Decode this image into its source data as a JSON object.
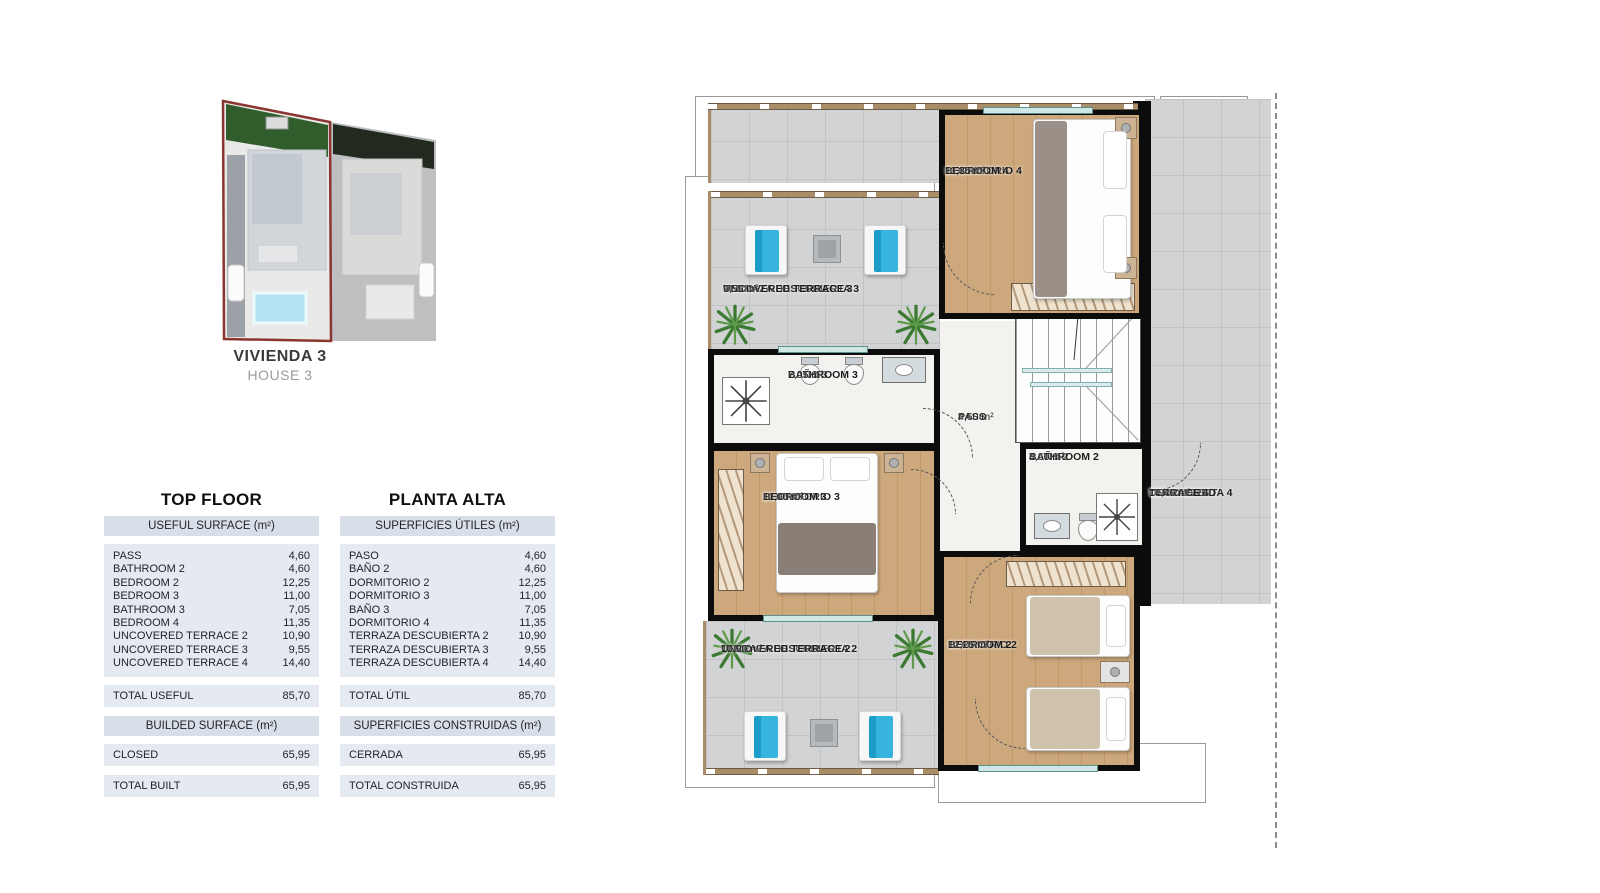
{
  "site_plan": {
    "name_es": "VIVIENDA 3",
    "name_en": "HOUSE 3",
    "highlight_color": "#8a3530"
  },
  "surface_tables": {
    "english": {
      "title": "TOP FLOOR",
      "useful_header": "USEFUL SURFACE (m²)",
      "rows": [
        {
          "label": "PASS",
          "value": "4,60"
        },
        {
          "label": "BATHROOM 2",
          "value": "4,60"
        },
        {
          "label": "BEDROOM 2",
          "value": "12,25"
        },
        {
          "label": "BEDROOM 3",
          "value": "11,00"
        },
        {
          "label": "BATHROOM 3",
          "value": "7,05"
        },
        {
          "label": "BEDROOM 4",
          "value": "11,35"
        },
        {
          "label": "UNCOVERED TERRACE 2",
          "value": "10,90"
        },
        {
          "label": "UNCOVERED TERRACE 3",
          "value": "9,55"
        },
        {
          "label": "UNCOVERED TERRACE 4",
          "value": "14,40"
        }
      ],
      "total": {
        "label": "TOTAL USEFUL",
        "value": "85,70"
      },
      "built_header": "BUILDED SURFACE (m²)",
      "closed": {
        "label": "CLOSED",
        "value": "65,95"
      },
      "total_built": {
        "label": "TOTAL BUILT",
        "value": "65,95"
      }
    },
    "spanish": {
      "title": "PLANTA ALTA",
      "useful_header": "SUPERFICIES ÚTILES (m²)",
      "rows": [
        {
          "label": "PASO",
          "value": "4,60"
        },
        {
          "label": "BAÑO 2",
          "value": "4,60"
        },
        {
          "label": "DORMITORIO 2",
          "value": "12,25"
        },
        {
          "label": "DORMITORIO 3",
          "value": "11,00"
        },
        {
          "label": "BAÑO 3",
          "value": "7,05"
        },
        {
          "label": "DORMITORIO 4",
          "value": "11,35"
        },
        {
          "label": "TERRAZA DESCUBIERTA 2",
          "value": "10,90"
        },
        {
          "label": "TERRAZA DESCUBIERTA 3",
          "value": "9,55"
        },
        {
          "label": "TERRAZA DESCUBIERTA 4",
          "value": "14,40"
        }
      ],
      "total": {
        "label": "TOTAL ÚTIL",
        "value": "85,70"
      },
      "built_header": "SUPERFICIES CONSTRUIDAS (m²)",
      "closed": {
        "label": "CERRADA",
        "value": "65,95"
      },
      "total_built": {
        "label": "TOTAL CONSTRUIDA",
        "value": "65,95"
      }
    }
  },
  "floor_plan": {
    "bedroom4": {
      "es": "DORMITORIO 4",
      "en": "BEDROOM 4",
      "area": "11,35 m²"
    },
    "terrace3": {
      "es": "TERRAZA DESCUBIERTA 3",
      "en": "UNCOVERED TERRACE 3",
      "area": "9,55 m²"
    },
    "bathroom3": {
      "es": "BAÑO 3",
      "en": "BATHROOM 3",
      "area": "7,05 m²"
    },
    "pass": {
      "es": "PASO",
      "en": "PASS",
      "area": "4,60 m²"
    },
    "bathroom2": {
      "es": "BAÑO 2",
      "en": "BATHROOM 2",
      "area": "4,60 m²"
    },
    "bedroom3": {
      "es": "DORMITORIO 3",
      "en": "BEDROOM 3",
      "area": "11,00 m²"
    },
    "terrace4": {
      "es1": "TERRAZA",
      "es2": "DESCUBIERTA 4",
      "en1": "UNCOVERED",
      "en2": "TERRACE 4",
      "area": "14,40 m²"
    },
    "terrace2": {
      "es": "TERRAZA DESCUBIERTA 2",
      "en": "UNCOVERED TERRACE 2",
      "area": "10,90 m²"
    },
    "bedroom2": {
      "es": "DORMITRIO 2",
      "en": "BEDROOM 2",
      "area": "12,25 m²"
    }
  },
  "colors": {
    "wall": "#0c0c0c",
    "wood_floor": "#c9a276",
    "terrace_tile": "#d1d3d4",
    "marble_floor": "#f3f2ef",
    "lounger_blue": "#36b4de",
    "plant_green": "#4c8a3c",
    "table_header_bg": "#d9dfe8",
    "table_row_bg": "#e5e9f0",
    "highlight_red": "#8a3530"
  }
}
